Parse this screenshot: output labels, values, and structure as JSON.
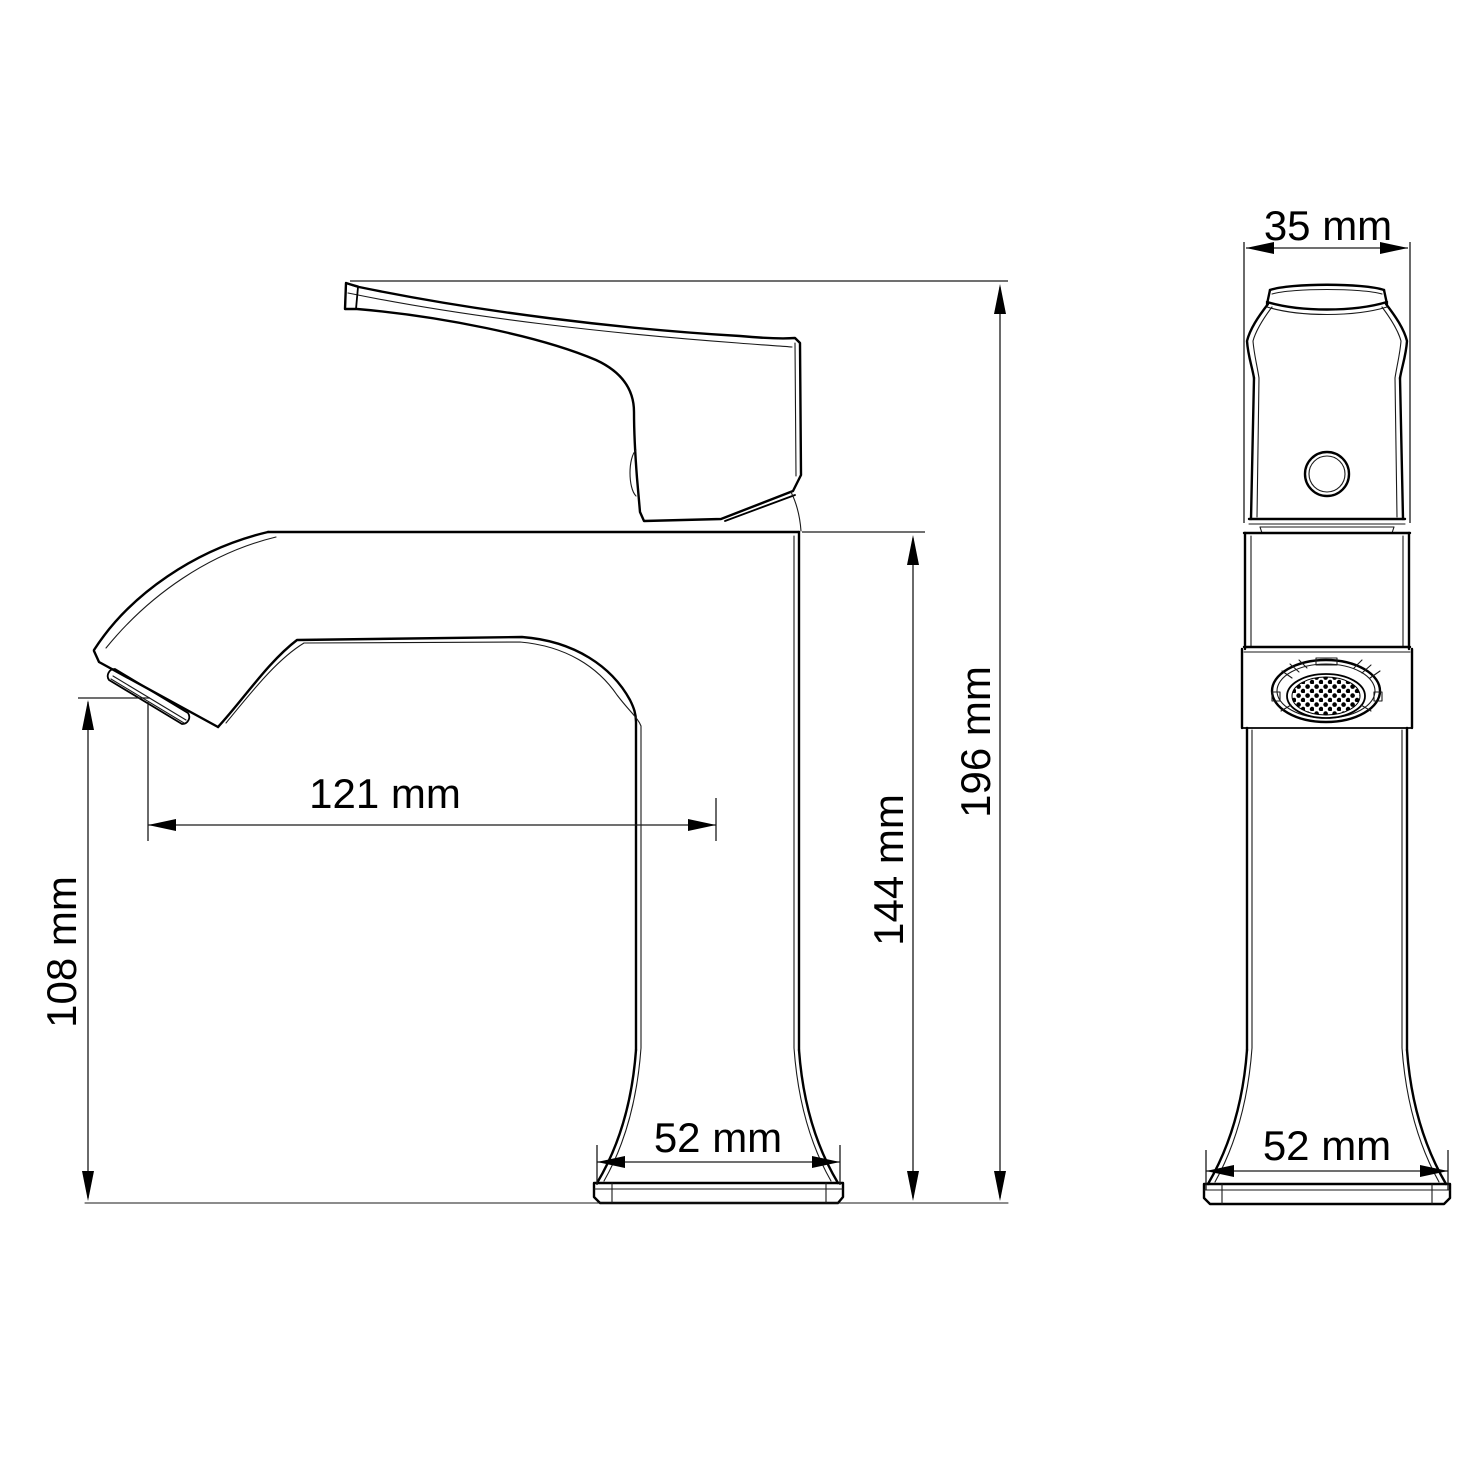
{
  "page": {
    "background_color": "#ffffff",
    "line_color": "#000000"
  },
  "diagram": {
    "type": "technical-drawing",
    "subject": "Single-handle bathroom basin faucet, dimensioned side and front views",
    "units": "mm",
    "views": [
      {
        "id": "side-view",
        "name": "side view"
      },
      {
        "id": "front-view",
        "name": "front view"
      }
    ],
    "dimensions": {
      "handle_width": {
        "label": "35 mm",
        "value": 35,
        "unit": "mm",
        "orientation": "horizontal",
        "view": "front",
        "measures": "handle width"
      },
      "overall_height": {
        "label": "196 mm",
        "value": 196,
        "unit": "mm",
        "orientation": "vertical",
        "view": "side",
        "measures": "overall height"
      },
      "spout_body_height": {
        "label": "144 mm",
        "value": 144,
        "unit": "mm",
        "orientation": "vertical",
        "view": "side",
        "measures": "height to top of spout body"
      },
      "spout_reach": {
        "label": "121 mm",
        "value": 121,
        "unit": "mm",
        "orientation": "horizontal",
        "view": "side",
        "measures": "spout reach"
      },
      "outlet_height": {
        "label": "108 mm",
        "value": 108,
        "unit": "mm",
        "orientation": "vertical",
        "view": "side",
        "measures": "spout outlet height"
      },
      "base_width_side": {
        "label": "52 mm",
        "value": 52,
        "unit": "mm",
        "orientation": "horizontal",
        "view": "side",
        "measures": "base width"
      },
      "base_width_front": {
        "label": "52 mm",
        "value": 52,
        "unit": "mm",
        "orientation": "horizontal",
        "view": "front",
        "measures": "base width"
      }
    }
  }
}
